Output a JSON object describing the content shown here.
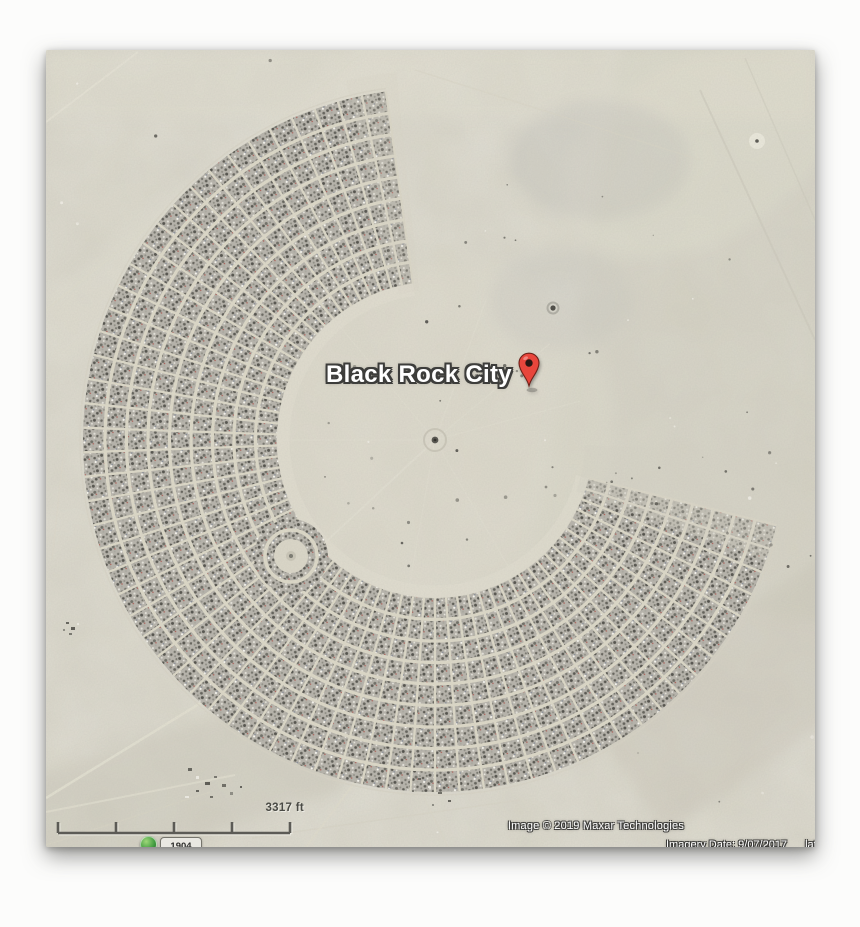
{
  "map": {
    "place_label": "Black Rock City",
    "scale_label": "3317 ft",
    "attribution": "Image © 2019 Maxar Technologies",
    "status": {
      "imagery_date": "Imagery Date: 9/07/2017",
      "latlon_fragment": "lat"
    },
    "year_badge": "1904",
    "colors": {
      "playa": "#d6d3c5",
      "playa_light": "#e3e0d2",
      "street": "#ddd9c8",
      "camp_base": "#b6b3aa",
      "scale_bar": "#5c5b56",
      "label_text": "#ffffff",
      "label_outline": "#3d3d3b",
      "pin_red": "#e8463c"
    },
    "geometry": {
      "center_x": 435,
      "center_y": 440,
      "inner_radius": 158,
      "outer_radius": 352,
      "start_angle_deg": 14,
      "end_angle_deg": 262,
      "ring_spacing": 21.5,
      "radial_step_deg": 4,
      "center_camp_x": 291,
      "center_camp_y": 556
    }
  }
}
